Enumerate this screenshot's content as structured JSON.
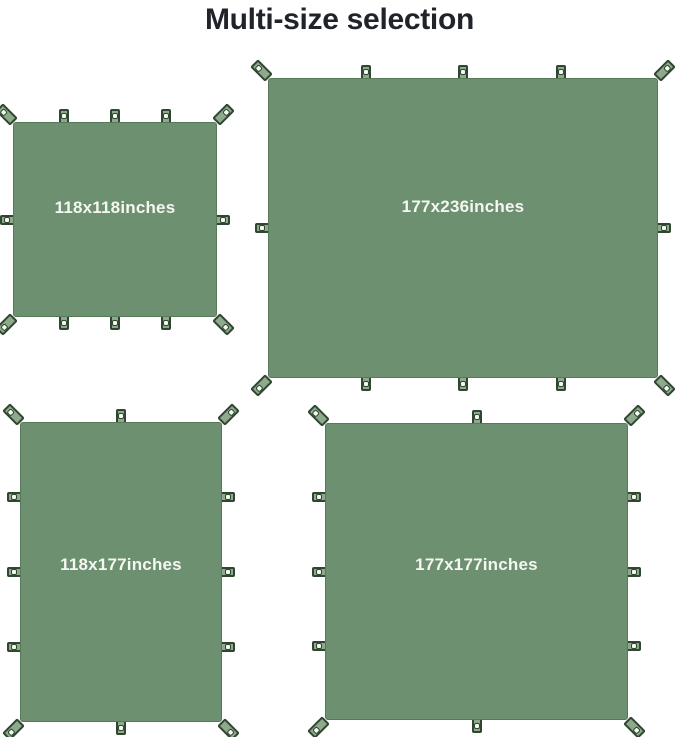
{
  "title": "Multi-size selection",
  "colors": {
    "background": "#ffffff",
    "title_text": "#20242a",
    "tarp_fill": "#6d9070",
    "tarp_edge": "#567a57",
    "tab_fill": "#8ea98c",
    "tab_edge": "#2f4630",
    "grommet_fill": "#f4f8f1",
    "label_text": "#f5f7f2"
  },
  "tarps": [
    {
      "label": "118x118inches",
      "width_inches": 118,
      "height_inches": 118,
      "loops": {
        "top": 3,
        "bottom": 3,
        "left": 1,
        "right": 1,
        "corners": 4
      }
    },
    {
      "label": "177x236inches",
      "width_inches": 236,
      "height_inches": 177,
      "loops": {
        "top": 3,
        "bottom": 3,
        "left": 1,
        "right": 1,
        "corners": 4
      }
    },
    {
      "label": "118x177inches",
      "width_inches": 118,
      "height_inches": 177,
      "loops": {
        "top": 1,
        "bottom": 1,
        "left": 3,
        "right": 3,
        "corners": 4
      }
    },
    {
      "label": "177x177inches",
      "width_inches": 177,
      "height_inches": 177,
      "loops": {
        "top": 1,
        "bottom": 1,
        "left": 3,
        "right": 3,
        "corners": 4
      }
    }
  ]
}
